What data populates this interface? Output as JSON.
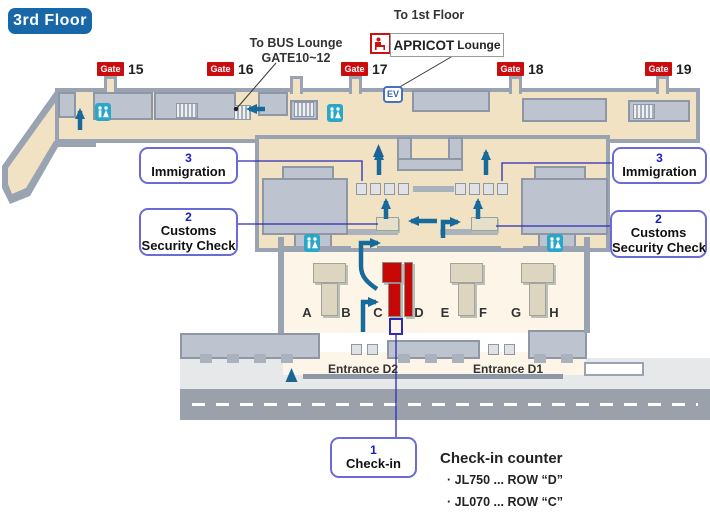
{
  "floor_badge": "3rd Floor",
  "annotations": {
    "bus_lounge_line1": "To BUS Lounge",
    "bus_lounge_line2": "GATE10~12",
    "to_first_floor": "To 1st Floor",
    "apricot_name": "APRICOT",
    "apricot_suffix": "Lounge"
  },
  "gates": [
    {
      "label": "Gate",
      "number": "15"
    },
    {
      "label": "Gate",
      "number": "16"
    },
    {
      "label": "Gate",
      "number": "17"
    },
    {
      "label": "Gate",
      "number": "18"
    },
    {
      "label": "Gate",
      "number": "19"
    }
  ],
  "elevator": "EV",
  "callouts": {
    "immigration_left": {
      "number": "3",
      "line1": "Immigration"
    },
    "immigration_right": {
      "number": "3",
      "line1": "Immigration"
    },
    "customs_left": {
      "number": "2",
      "line1": "Customs",
      "line2": "Security Check"
    },
    "customs_right": {
      "number": "2",
      "line1": "Customs",
      "line2": "Security Check"
    },
    "checkin": {
      "number": "1",
      "line1": "Check-in"
    }
  },
  "counter_letters": [
    "A",
    "B",
    "C",
    "D",
    "E",
    "F",
    "G",
    "H"
  ],
  "entrances": {
    "d2": "Entrance D2",
    "d1": "Entrance D1"
  },
  "legend": {
    "title": "Check-in counter",
    "items": [
      "· JL750 ... ROW “D”",
      "· JL070 ... ROW “C”"
    ]
  },
  "colors": {
    "floor_badge_blue": "#1767a9",
    "gate_red": "#cb0c0f",
    "highlight_red": "#c80707",
    "arrow_teal": "#186a9d",
    "callout_border": "#6b6bd6",
    "connector_blue": "#2b2bb8",
    "toilet_cyan": "#2aa7c7",
    "concourse_beige": "#f1e2c3",
    "hall_cream": "#fcf5e8",
    "wall_gray": "#9aa3b2"
  }
}
